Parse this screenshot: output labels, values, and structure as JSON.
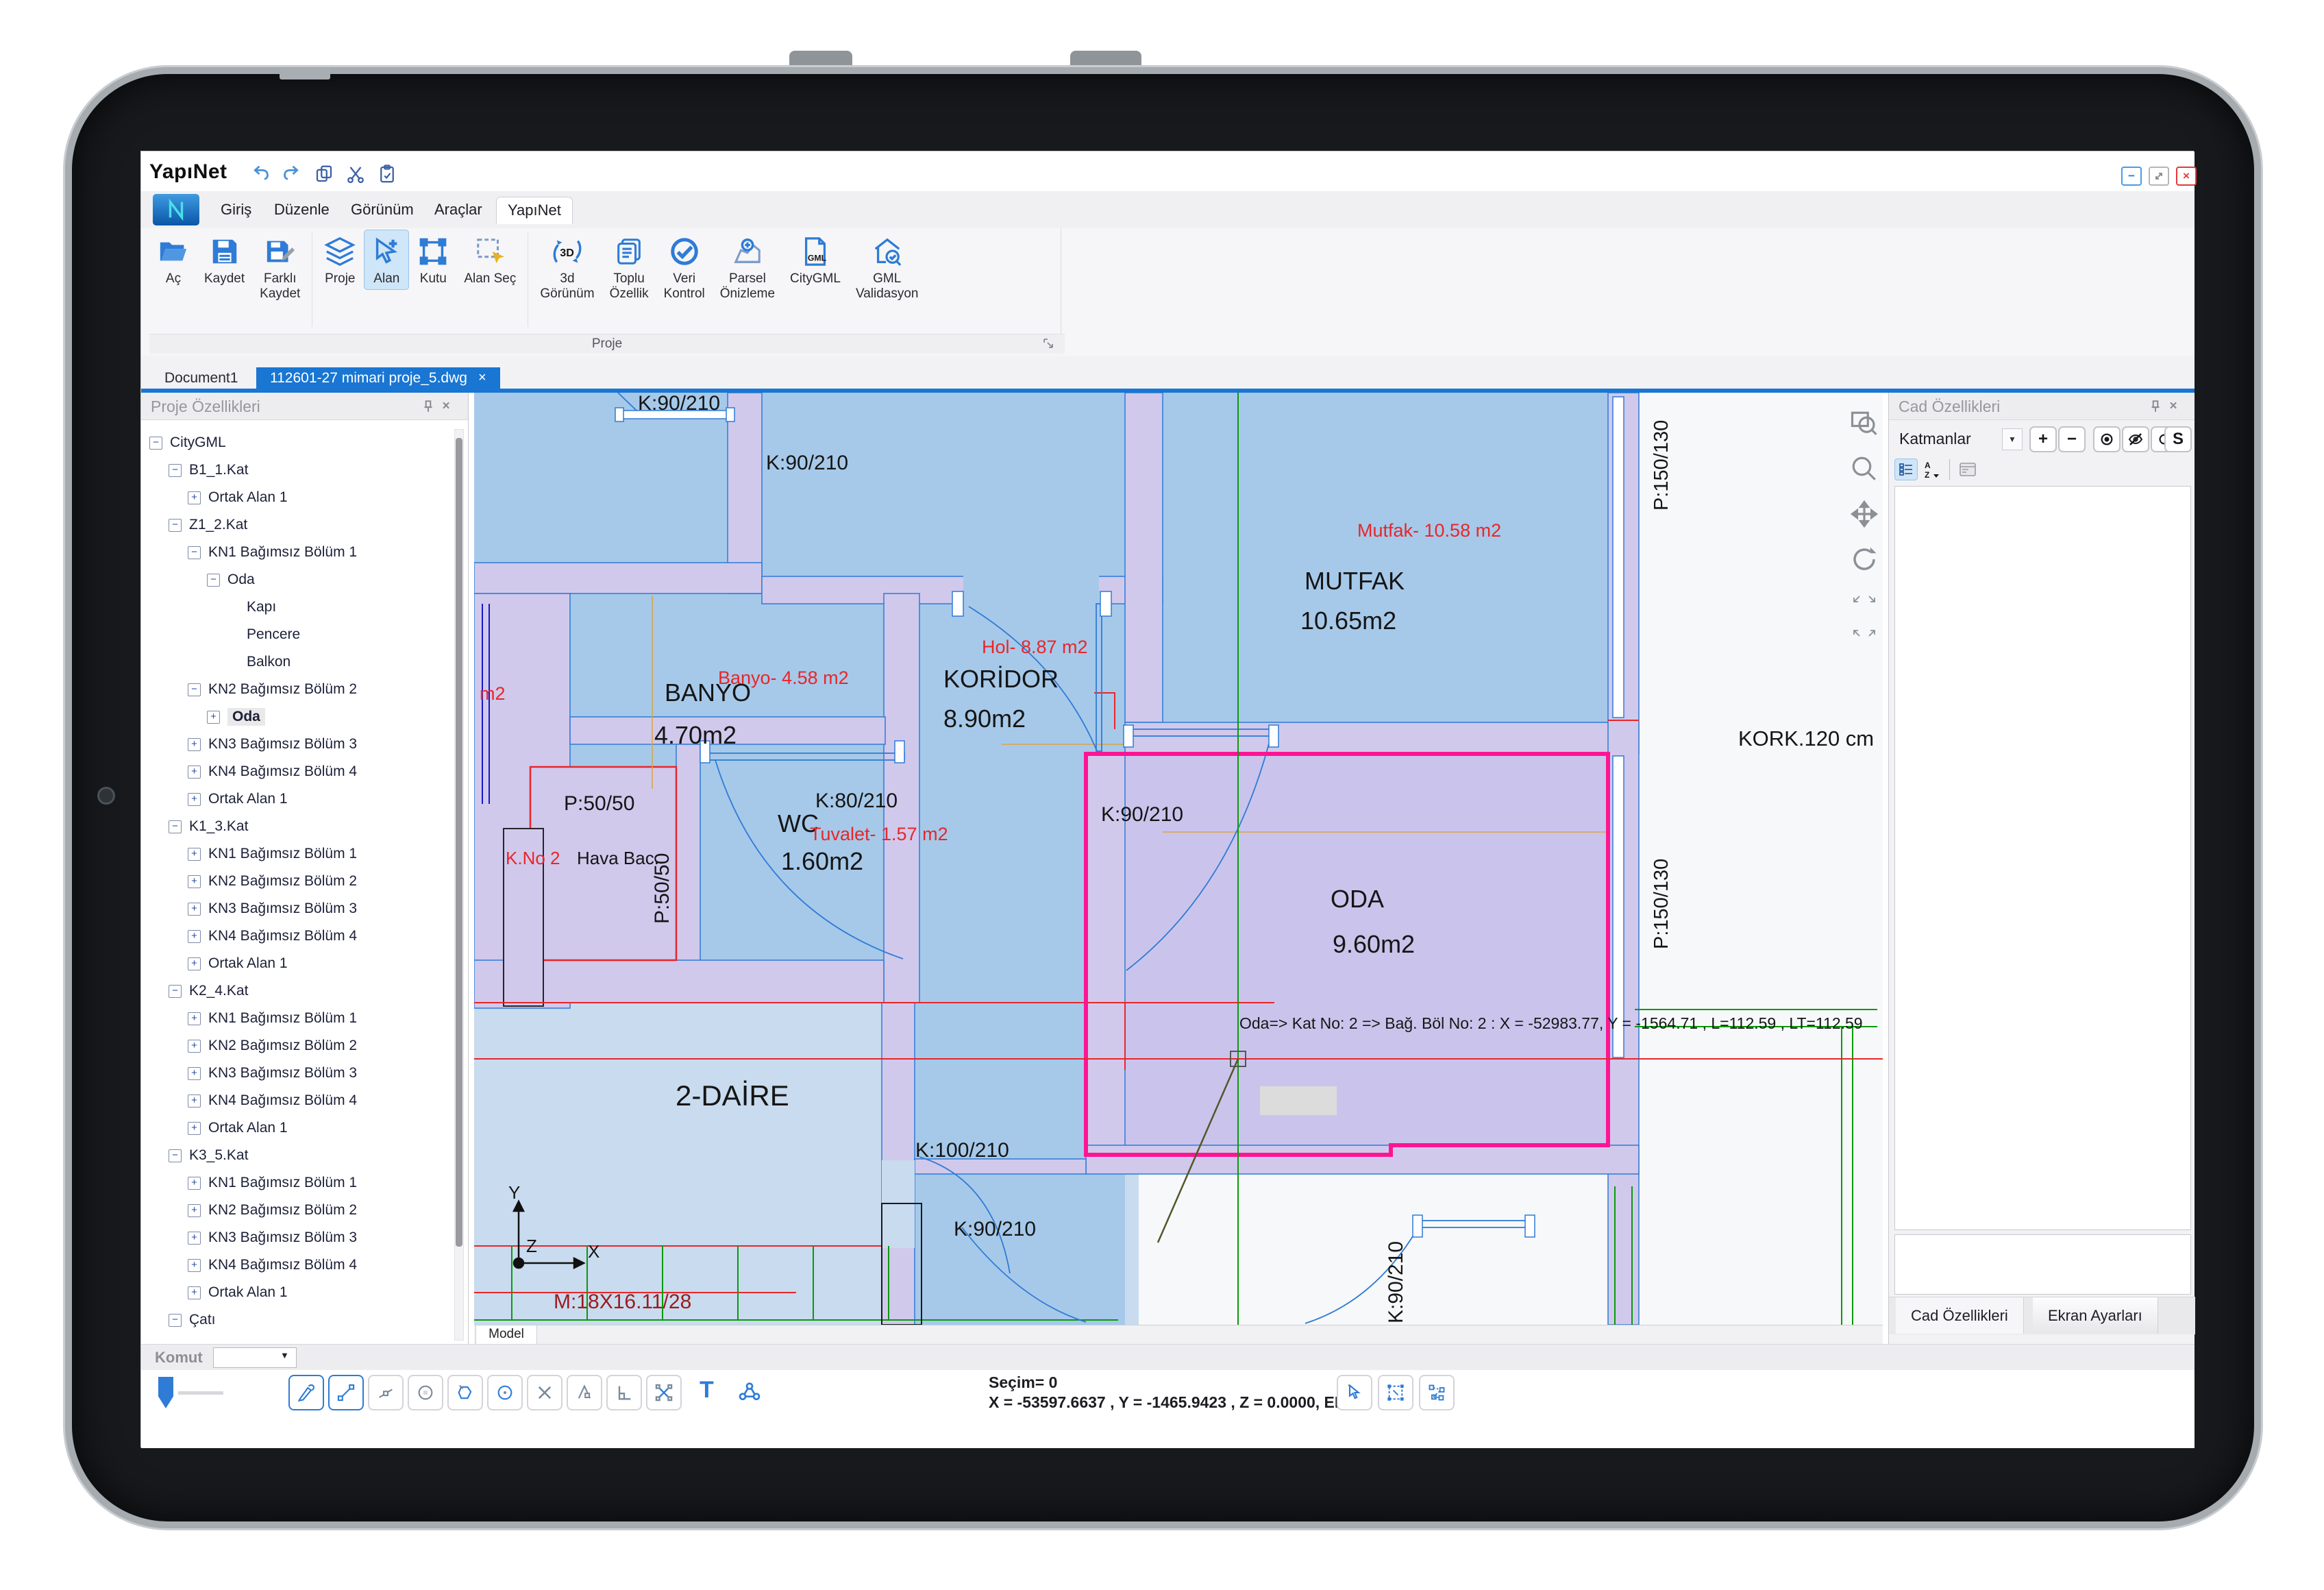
{
  "window": {
    "title": "YapıNet",
    "controls": {
      "minimize": "−",
      "maximize": "",
      "close": "×"
    }
  },
  "menu": {
    "tabs": [
      {
        "label": "Giriş"
      },
      {
        "label": "Düzenle"
      },
      {
        "label": "Görünüm"
      },
      {
        "label": "Araçlar"
      },
      {
        "label": "YapıNet",
        "active": true
      }
    ]
  },
  "ribbon": {
    "group_label": "Proje",
    "icon_texts": {
      "threed": "3D",
      "gml_small": "GML"
    },
    "buttons": [
      {
        "label": "Aç",
        "icon": "open-folder-icon"
      },
      {
        "label": "Kaydet",
        "icon": "save-icon"
      },
      {
        "label": "Farklı\nKaydet",
        "icon": "save-as-icon"
      },
      {
        "label": "Proje",
        "icon": "project-icon"
      },
      {
        "label": "Alan",
        "icon": "area-icon",
        "active": true
      },
      {
        "label": "Kutu",
        "icon": "box-icon"
      },
      {
        "label": "Alan Seç",
        "icon": "area-select-icon"
      },
      {
        "label": "3d\nGörünüm",
        "icon": "3d-view-icon"
      },
      {
        "label": "Toplu\nÖzellik",
        "icon": "bulk-properties-icon"
      },
      {
        "label": "Veri\nKontrol",
        "icon": "data-check-icon"
      },
      {
        "label": "Parsel\nÖnizleme",
        "icon": "parcel-preview-icon"
      },
      {
        "label": "CityGML",
        "icon": "citygml-icon"
      },
      {
        "label": "GML\nValidasyon",
        "icon": "gml-validation-icon"
      }
    ]
  },
  "doc_tabs": {
    "tabs": [
      {
        "label": "Document1"
      },
      {
        "label": "112601-27 mimari proje_5.dwg",
        "active": true,
        "close": "×"
      }
    ]
  },
  "left_panel": {
    "title": "Proje Özellikleri",
    "close": "×",
    "tree": [
      {
        "label": "CityGML",
        "g": "−"
      },
      {
        "label": "B1_1.Kat",
        "g": "−"
      },
      {
        "label": "Ortak Alan 1",
        "g": "+"
      },
      {
        "label": "Z1_2.Kat",
        "g": "−"
      },
      {
        "label": "KN1 Bağımsız Bölüm 1",
        "g": "−"
      },
      {
        "label": "Oda",
        "g": "−"
      },
      {
        "label": "Kapı",
        "g": ""
      },
      {
        "label": "Pencere",
        "g": ""
      },
      {
        "label": "Balkon",
        "g": ""
      },
      {
        "label": "KN2 Bağımsız Bölüm 2",
        "g": "−"
      },
      {
        "label": "Oda",
        "g": "+",
        "selected": true
      },
      {
        "label": "KN3 Bağımsız Bölüm 3",
        "g": "+"
      },
      {
        "label": "KN4 Bağımsız Bölüm 4",
        "g": "+"
      },
      {
        "label": "Ortak Alan 1",
        "g": "+"
      },
      {
        "label": "K1_3.Kat",
        "g": "−"
      },
      {
        "label": "KN1 Bağımsız Bölüm 1",
        "g": "+"
      },
      {
        "label": "KN2 Bağımsız Bölüm 2",
        "g": "+"
      },
      {
        "label": "KN3 Bağımsız Bölüm 3",
        "g": "+"
      },
      {
        "label": "KN4 Bağımsız Bölüm 4",
        "g": "+"
      },
      {
        "label": "Ortak Alan 1",
        "g": "+"
      },
      {
        "label": "K2_4.Kat",
        "g": "−"
      },
      {
        "label": "KN1 Bağımsız Bölüm 1",
        "g": "+"
      },
      {
        "label": "KN2 Bağımsız Bölüm 2",
        "g": "+"
      },
      {
        "label": "KN3 Bağımsız Bölüm 3",
        "g": "+"
      },
      {
        "label": "KN4 Bağımsız Bölüm 4",
        "g": "+"
      },
      {
        "label": "Ortak Alan 1",
        "g": "+"
      },
      {
        "label": "K3_5.Kat",
        "g": "−"
      },
      {
        "label": "KN1 Bağımsız Bölüm 1",
        "g": "+"
      },
      {
        "label": "KN2 Bağımsız Bölüm 2",
        "g": "+"
      },
      {
        "label": "KN3 Bağımsız Bölüm 3",
        "g": "+"
      },
      {
        "label": "KN4 Bağımsız Bölüm 4",
        "g": "+"
      },
      {
        "label": "Ortak Alan 1",
        "g": "+"
      },
      {
        "label": "Çatı",
        "g": "−"
      }
    ]
  },
  "canvas": {
    "model_tab": "Model",
    "rooms": [
      {
        "name": "BANYO",
        "area": "4.70m2"
      },
      {
        "name": "MUTFAK",
        "area": "10.65m2"
      },
      {
        "name": "KORİDOR",
        "area": "8.90m2"
      },
      {
        "name": "WC",
        "area": "1.60m2"
      },
      {
        "name": "ODA",
        "area": "9.60m2"
      },
      {
        "name": "2-DAİRE",
        "area": ""
      }
    ],
    "red_labels": {
      "banyo": "Banyo- 4.58 m2",
      "mutfak": "Mutfak- 10.58 m2",
      "hol": "Hol- 8.87 m2",
      "tuvalet": "Tuvalet- 1.57 m2",
      "kno": "K.No 2",
      "m2_partial": "m2"
    },
    "black_labels": {
      "hava": "Hava Bac.",
      "kork": "KORK.120 cm",
      "merdiven": "M:18X16.11/28"
    },
    "door_labels": {
      "d1": "K:90/210",
      "d2": "K:90/210",
      "d3": "K:90/210",
      "d4": "K:90/210",
      "d5": "K:90/210",
      "d80": "K:80/210",
      "d100": "K:100/210"
    },
    "window_labels": {
      "p50h": "P:50/50",
      "p50v": "P:50/50",
      "p150a": "P:150/130",
      "p150b": "P:150/130"
    },
    "axis": {
      "x": "X",
      "y": "Y",
      "z": "Z"
    },
    "tooltip": "Oda=> Kat No: 2 =>  Bağ. Böl No: 2 : X = -52983.77, Y = -1564.71 , L=112.59 , LT=112.59"
  },
  "right_panel": {
    "title": "Cad Özellikleri",
    "close": "×",
    "layers_label": "Katmanlar",
    "toolbar": {
      "plus": "+",
      "minus": "−",
      "s": "S",
      "sort_a": "A",
      "sort_z": "Z"
    },
    "bottom_tabs": [
      {
        "label": "Cad Özellikleri",
        "active": true
      },
      {
        "label": "Ekran Ayarları"
      }
    ]
  },
  "bottom": {
    "command_label": "Komut",
    "combo_value": "",
    "selection": "Seçim= 0",
    "coords": "X = -53597.6637 , Y = -1465.9423 , Z = 0.0000, EPSG:",
    "text_tool": "T"
  },
  "colors": {
    "accent": "#1976d2",
    "ribbon_icon": "#2e7cd6",
    "selection_pink": "#ff1493",
    "floor_blue": "#a6c9e9",
    "floor_light": "#c9dbee",
    "wall_lavender": "#d0c9ec",
    "cad_red": "#e8262a",
    "cad_green": "#0a9a0a",
    "close_red": "#e23b3b"
  }
}
